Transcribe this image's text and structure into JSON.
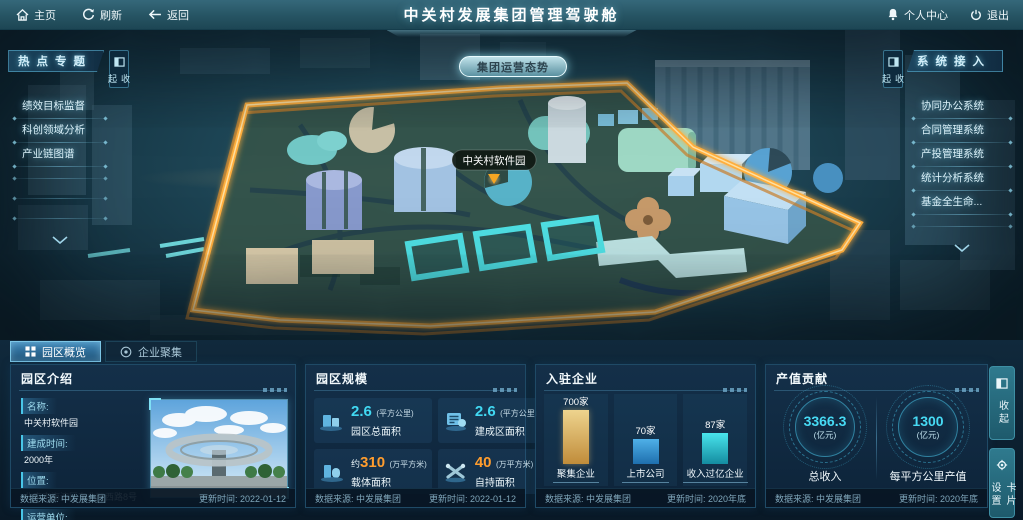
{
  "topbar": {
    "home": "主页",
    "refresh": "刷新",
    "back": "返回",
    "title": "中关村发展集团管理驾驶舱",
    "personal_center": "个人中心",
    "logout": "退出"
  },
  "hot_topics": {
    "title": "热点专题",
    "collapse": "收起",
    "items": [
      "绩效目标监督",
      "科创领域分析",
      "产业链图谱"
    ]
  },
  "systems": {
    "title": "系统接入",
    "collapse": "收起",
    "items": [
      "协同办公系统",
      "合同管理系统",
      "产投管理系统",
      "统计分析系统",
      "基金全生命..."
    ]
  },
  "map": {
    "overview_button": "集团运营态势",
    "marker_label": "中关村软件园"
  },
  "tabs": {
    "overview": "园区概览",
    "enterprises": "企业聚集"
  },
  "panels": {
    "intro": {
      "title": "园区介绍",
      "fields": [
        {
          "label": "名称:",
          "value": "中关村软件园"
        },
        {
          "label": "建成时间:",
          "value": "2000年"
        },
        {
          "label": "位置:",
          "value": "北京市海淀区东北旺西路8号"
        },
        {
          "label": "运营单位:",
          "value": "北京中关村软件园发展有限公司"
        }
      ],
      "source": "数据来源: 中发展集团",
      "updated": "更新时间: 2022-01-12"
    },
    "scale": {
      "title": "园区规模",
      "stats": [
        {
          "prefix": "",
          "value": "2.6",
          "unit": "(平方公里)",
          "label": "园区总面积"
        },
        {
          "prefix": "",
          "value": "2.6",
          "unit": "(平方公里)",
          "label": "建成区面积"
        },
        {
          "prefix": "约",
          "value": "310",
          "unit": "(万平方米)",
          "label": "载体面积"
        },
        {
          "prefix": "",
          "value": "40",
          "unit": "(万平方米)",
          "label": "自持面积"
        }
      ],
      "source": "数据来源: 中发展集团",
      "updated": "更新时间: 2022-01-12"
    },
    "enterprises": {
      "title": "入驻企业",
      "chart_data": {
        "type": "bar",
        "categories": [
          "聚集企业",
          "上市公司",
          "收入过亿企业"
        ],
        "values": [
          700,
          70,
          87
        ],
        "unit": "家",
        "value_labels": [
          "700家",
          "70家",
          "87家"
        ],
        "colors": [
          "#d9a94f",
          "#2f94d8",
          "#35dce0"
        ],
        "legend": false,
        "grid": false
      },
      "source": "数据来源: 中发展集团",
      "updated": "更新时间: 2020年底"
    },
    "output": {
      "title": "产值贡献",
      "gauges": [
        {
          "value": "3366.3",
          "unit": "(亿元)",
          "label": "总收入"
        },
        {
          "value": "1300",
          "unit": "(亿元)",
          "label": "每平方公里产值"
        }
      ],
      "source": "数据来源: 中发展集团",
      "updated": "更新时间: 2020年底"
    }
  },
  "side_buttons": {
    "collapse": "收起",
    "card_settings": "卡片设置"
  },
  "colors": {
    "accent_cyan": "#3fd6f2",
    "accent_orange": "#ff9d2e",
    "bar_gold": "#d9a94f",
    "bar_blue": "#2f94d8",
    "bar_cyan": "#35dce0",
    "border_gold": "#ffb84d"
  }
}
